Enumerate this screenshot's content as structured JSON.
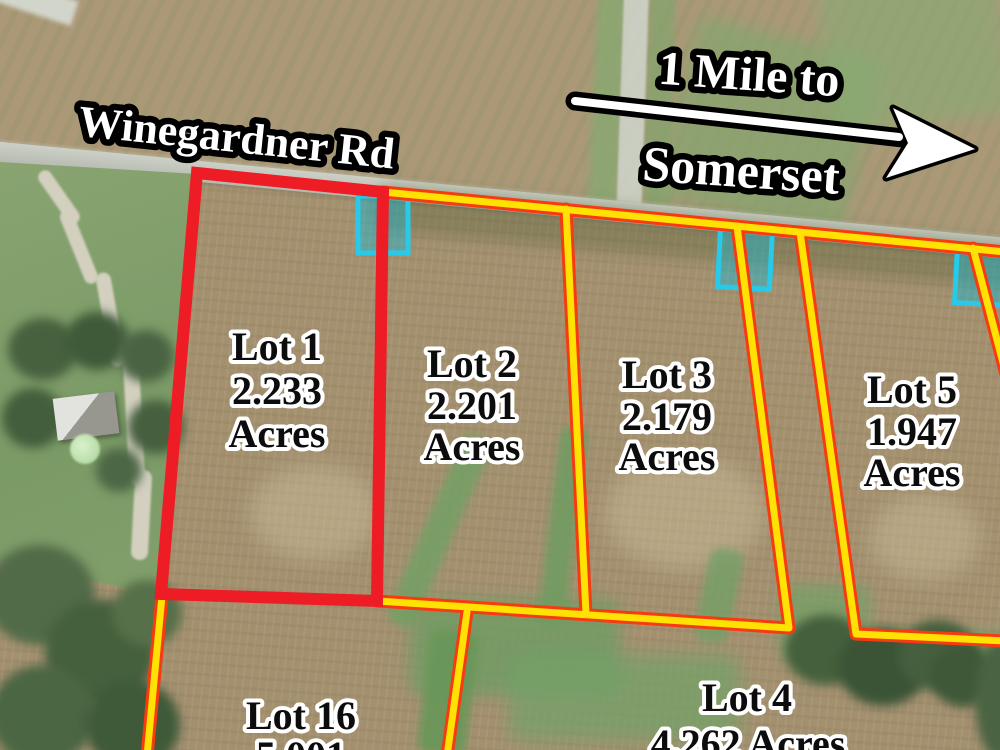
{
  "map": {
    "road_label": "Winegardner Rd",
    "direction_sign": {
      "line1": "1 Mile to",
      "line2": "Somerset"
    },
    "lots": [
      {
        "id": "lot-1",
        "name": "Lot 1",
        "acreage": "2.233",
        "unit": "Acres",
        "outline_color": "#ee1c24"
      },
      {
        "id": "lot-2",
        "name": "Lot 2",
        "acreage": "2.201",
        "unit": "Acres",
        "outline_color": "#ffe103"
      },
      {
        "id": "lot-3",
        "name": "Lot 3",
        "acreage": "2.179",
        "unit": "Acres",
        "outline_color": "#ffe103"
      },
      {
        "id": "lot-5",
        "name": "Lot 5",
        "acreage": "1.947",
        "unit": "Acres",
        "outline_color": "#ffe103"
      },
      {
        "id": "lot-16",
        "name": "Lot 16",
        "acreage": "5.001",
        "outline_color": "#ffe103"
      },
      {
        "id": "lot-4",
        "name": "Lot 4",
        "acreage_line": "4.262 Acres",
        "outline_color": "#ffe103"
      }
    ],
    "colors": {
      "lot_line_core": "#ffe103",
      "lot_line_casing": "#f63b10",
      "featured_lot_outline": "#ee1c24",
      "utility_marker": "#29c9e9",
      "sign_text_fill": "#ffffff",
      "sign_text_outline": "#000000",
      "lot_text_fill": "#0c0c0c",
      "lot_text_outline": "#ffffff"
    },
    "markers": [
      {
        "id": "marker-1",
        "type": "driveway-marker"
      },
      {
        "id": "marker-2",
        "type": "driveway-marker"
      },
      {
        "id": "marker-3",
        "type": "driveway-marker"
      }
    ]
  }
}
